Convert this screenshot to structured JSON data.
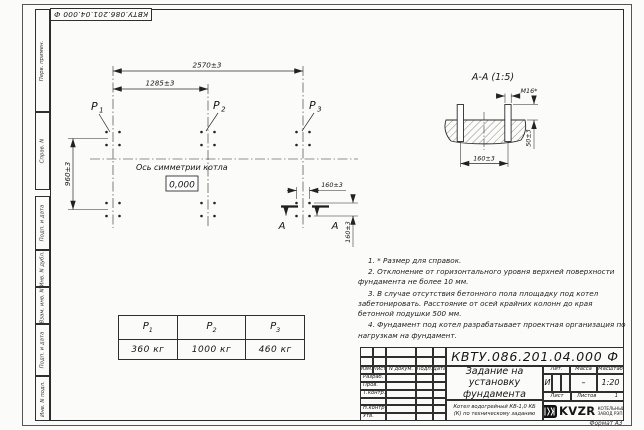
{
  "designation": "КВТУ.086.201.04.000 Ф",
  "frame": {
    "format_note": "Формат А3",
    "stamps_top": [
      "Перв. примен.",
      "Справ. N"
    ],
    "stamps_bottom": [
      "Подп. и дата",
      "Инв. N дубл.",
      "Взам. инв. N",
      "Подп. и дата",
      "Инв. N подл."
    ]
  },
  "plan": {
    "dim_width_total": "2570±3",
    "dim_width_half": "1285±3",
    "dim_depth": "960±3",
    "dim_bolt_h": "160±3",
    "dim_bolt_v": "160±3",
    "axis_label": "Ось симметрии котла",
    "elevation_mark": "0,000",
    "p_labels": [
      {
        "name": "P",
        "sub": "1"
      },
      {
        "name": "P",
        "sub": "2"
      },
      {
        "name": "P",
        "sub": "3"
      }
    ],
    "section_letter": "А"
  },
  "section": {
    "title": "А-А (1:5)",
    "thread_label": "М16*",
    "dim_height": "50±3",
    "dim_spacing": "160±3"
  },
  "load_table": {
    "headers": [
      {
        "name": "P",
        "sub": "1"
      },
      {
        "name": "P",
        "sub": "2"
      },
      {
        "name": "P",
        "sub": "3"
      }
    ],
    "values": [
      "360 кг",
      "1000 кг",
      "460 кг"
    ]
  },
  "notes": [
    "1. * Размер для справок.",
    "2. Отклонение от горизонтального уровня верхней поверхности фундамента не более 10 мм.",
    "3. В случае отсутствия бетонного пола площадку под котел забетонировать. Расстояние от осей крайних колонн до края бетонной подушки 500 мм.",
    "4. Фундамент под котел разрабатывает проектная организация по нагрузкам на фундамент."
  ],
  "title_block": {
    "designation": "КВТУ.086.201.04.000 Ф",
    "doc_title": "Задание на установку фундамента",
    "doc_subtitle": "Котел водогрейный КВ-1,0 КБ (К) по техническому заданию",
    "header_cols": [
      "Изм.",
      "Лист",
      "N докум.",
      "Подп.",
      "Дата"
    ],
    "sign_labels": [
      "Разраб.",
      "Пров.",
      "Т.контр.",
      "Н.контр.",
      "Утв."
    ],
    "lit_header": "Лит.",
    "mass_header": "Масса",
    "scale_header": "Масштаб",
    "lit_value": "И",
    "mass_value": "–",
    "scale_value": "1:20",
    "sheet_label": "Лист",
    "sheets_label": "Листов",
    "sheets_value": "1",
    "company_name": "KVZR",
    "company_desc1": "КОТЕЛЬНЫЙ",
    "company_desc2": "ЗАВОД РЭП"
  }
}
